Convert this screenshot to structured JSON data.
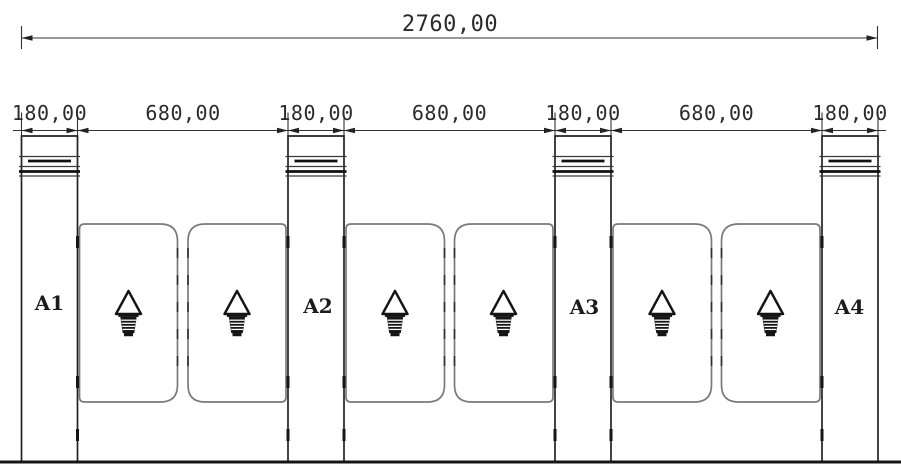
{
  "dimensions": {
    "overall": "2760,00",
    "segments": [
      "180,00",
      "680,00",
      "180,00",
      "680,00",
      "180,00",
      "680,00",
      "180,00"
    ]
  },
  "pillars": [
    "A1",
    "A2",
    "A3",
    "A4"
  ],
  "icons": {
    "passage_arrow": "passage-direction-arrow-icon"
  },
  "colors": {
    "line": "#2b2b2b",
    "wing_outline": "#7a7a7a",
    "dark_fill": "#161616",
    "background": "#ffffff"
  }
}
